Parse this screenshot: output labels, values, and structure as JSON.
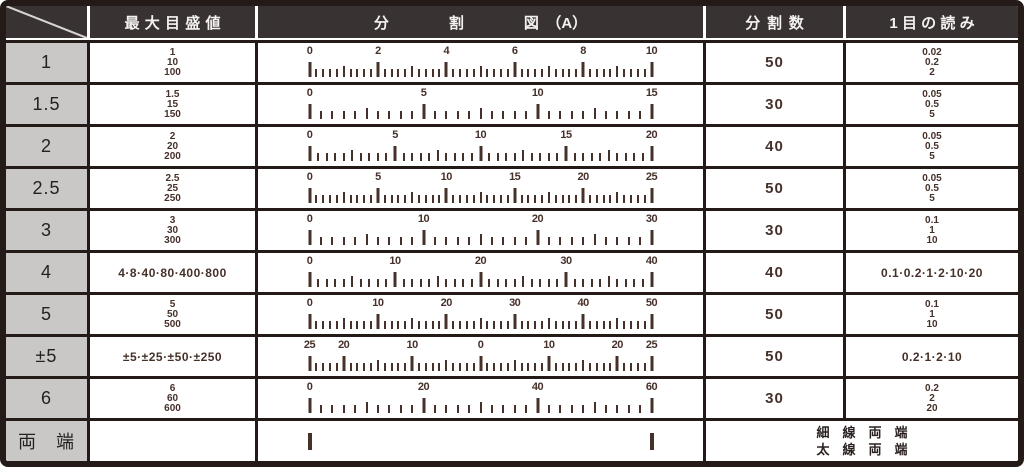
{
  "header": {
    "corner": "",
    "max_scale": "最大目盛値",
    "division_figure": "分　　　　割　　　　図　（A）",
    "division_count": "分割数",
    "reading": "1目の読み"
  },
  "rows": [
    {
      "label": "1",
      "max_values": [
        "1",
        "10",
        "100"
      ],
      "ruler": {
        "divisions": 50,
        "labels": [
          {
            "t": "0",
            "i": 0
          },
          {
            "t": "2",
            "i": 10
          },
          {
            "t": "4",
            "i": 20
          },
          {
            "t": "6",
            "i": 30
          },
          {
            "t": "8",
            "i": 40
          },
          {
            "t": "10",
            "i": 50
          }
        ]
      },
      "division_count": "50",
      "readings": [
        "0.02",
        "0.2",
        "2"
      ]
    },
    {
      "label": "1.5",
      "max_values": [
        "1.5",
        "15",
        "150"
      ],
      "ruler": {
        "divisions": 30,
        "labels": [
          {
            "t": "0",
            "i": 0
          },
          {
            "t": "5",
            "i": 10
          },
          {
            "t": "10",
            "i": 20
          },
          {
            "t": "15",
            "i": 30
          }
        ]
      },
      "division_count": "30",
      "readings": [
        "0.05",
        "0.5",
        "5"
      ]
    },
    {
      "label": "2",
      "max_values": [
        "2",
        "20",
        "200"
      ],
      "ruler": {
        "divisions": 40,
        "labels": [
          {
            "t": "0",
            "i": 0
          },
          {
            "t": "5",
            "i": 10
          },
          {
            "t": "10",
            "i": 20
          },
          {
            "t": "15",
            "i": 30
          },
          {
            "t": "20",
            "i": 40
          }
        ]
      },
      "division_count": "40",
      "readings": [
        "0.05",
        "0.5",
        "5"
      ]
    },
    {
      "label": "2.5",
      "max_values": [
        "2.5",
        "25",
        "250"
      ],
      "ruler": {
        "divisions": 50,
        "labels": [
          {
            "t": "0",
            "i": 0
          },
          {
            "t": "5",
            "i": 10
          },
          {
            "t": "10",
            "i": 20
          },
          {
            "t": "15",
            "i": 30
          },
          {
            "t": "20",
            "i": 40
          },
          {
            "t": "25",
            "i": 50
          }
        ]
      },
      "division_count": "50",
      "readings": [
        "0.05",
        "0.5",
        "5"
      ]
    },
    {
      "label": "3",
      "max_values": [
        "3",
        "30",
        "300"
      ],
      "ruler": {
        "divisions": 30,
        "labels": [
          {
            "t": "0",
            "i": 0
          },
          {
            "t": "10",
            "i": 10
          },
          {
            "t": "20",
            "i": 20
          },
          {
            "t": "30",
            "i": 30
          }
        ]
      },
      "division_count": "30",
      "readings": [
        "0.1",
        "1",
        "10"
      ]
    },
    {
      "label": "4",
      "max_values": [
        "4·8·40·80·400·800"
      ],
      "ruler": {
        "divisions": 40,
        "labels": [
          {
            "t": "0",
            "i": 0
          },
          {
            "t": "10",
            "i": 10
          },
          {
            "t": "20",
            "i": 20
          },
          {
            "t": "30",
            "i": 30
          },
          {
            "t": "40",
            "i": 40
          }
        ]
      },
      "division_count": "40",
      "readings": [
        "0.1·0.2·1·2·10·20"
      ]
    },
    {
      "label": "5",
      "max_values": [
        "5",
        "50",
        "500"
      ],
      "ruler": {
        "divisions": 50,
        "labels": [
          {
            "t": "0",
            "i": 0
          },
          {
            "t": "10",
            "i": 10
          },
          {
            "t": "20",
            "i": 20
          },
          {
            "t": "30",
            "i": 30
          },
          {
            "t": "40",
            "i": 40
          },
          {
            "t": "50",
            "i": 50
          }
        ]
      },
      "division_count": "50",
      "readings": [
        "0.1",
        "1",
        "10"
      ]
    },
    {
      "label": "±5",
      "max_values": [
        "±5·±25·±50·±250"
      ],
      "ruler": {
        "divisions": 50,
        "labels": [
          {
            "t": "25",
            "i": 0
          },
          {
            "t": "20",
            "i": 5
          },
          {
            "t": "10",
            "i": 15
          },
          {
            "t": "0",
            "i": 25
          },
          {
            "t": "10",
            "i": 35
          },
          {
            "t": "20",
            "i": 45
          },
          {
            "t": "25",
            "i": 50
          }
        ]
      },
      "division_count": "50",
      "readings": [
        "0.2·1·2·10"
      ]
    },
    {
      "label": "6",
      "max_values": [
        "6",
        "60",
        "600"
      ],
      "ruler": {
        "divisions": 30,
        "labels": [
          {
            "t": "0",
            "i": 0
          },
          {
            "t": "20",
            "i": 10
          },
          {
            "t": "40",
            "i": 20
          },
          {
            "t": "60",
            "i": 30
          }
        ]
      },
      "division_count": "30",
      "readings": [
        "0.2",
        "2",
        "20"
      ]
    }
  ],
  "footer_row": {
    "label": "両　端",
    "note_lines": [
      "細　線　両　端",
      "太　線　両　端"
    ]
  },
  "colors": {
    "header_bg": "#383233",
    "header_text": "#f4f2f1",
    "label_bg": "#cac7c7",
    "ink": "#46312a",
    "grid_line": "#241b19"
  }
}
